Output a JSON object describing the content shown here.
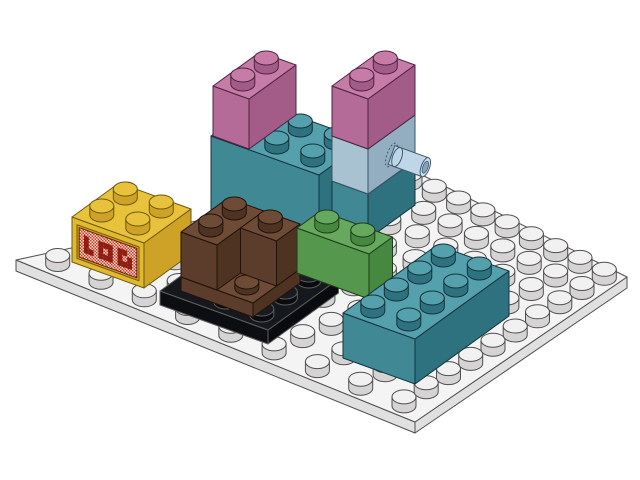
{
  "scene": {
    "description": "Isometric LDraw-style render of a small LEGO assembly on a white studded baseplate",
    "background": "#ffffff",
    "projection": {
      "u": [
        23.5,
        -17
      ],
      "v": [
        36,
        13
      ],
      "brick_height_px": 45,
      "stud": {
        "rx": 12,
        "ry": 7,
        "h": 9
      }
    },
    "baseplate": {
      "part": "white baseplate (approx 10 x 8 studs)",
      "color_name": "white",
      "quad": [
        [
          16,
          260
        ],
        [
          418,
          173
        ],
        [
          627,
          277
        ],
        [
          415,
          422
        ]
      ],
      "cols": 10,
      "rows": 9,
      "thickness": 11,
      "colors": {
        "top": "#f4f4f4",
        "side": "#e1e0e0",
        "stud_top": "#f1f1f1",
        "stud_side": "#d5d3d3",
        "outline": "#4f4f4f"
      }
    },
    "pieces": [
      {
        "id": "wide-teal-brick",
        "part": "Brick 2x3 tall (double height)",
        "color_name": "teal",
        "anchor": [
          211,
          224
        ],
        "w": 2,
        "d": 3,
        "h": 88,
        "studs": "all",
        "colors": {
          "top": "#54a0ac",
          "left": "#3f8894",
          "right": "#2e717f",
          "stud_top": "#54a0ac",
          "stud_side": "#2e717f",
          "outline": "#16333b"
        }
      },
      {
        "id": "pink-brick-1",
        "part": "Brick 1x2x2 tall",
        "color_name": "dark pink",
        "anchor": [
          213,
          136
        ],
        "w": 2,
        "d": 1,
        "h": 50,
        "studs": "all",
        "colors": {
          "top": "#c77ca8",
          "left": "#b56b97",
          "right": "#a35c88",
          "stud_top": "#c77ca8",
          "stud_side": "#a35c88",
          "outline": "#4e2440"
        }
      },
      {
        "id": "tower-teal-brick",
        "part": "Brick 1x2 (tower base)",
        "color_name": "teal",
        "anchor": [
          332,
          226
        ],
        "w": 2,
        "d": 1,
        "h": 45,
        "studs": [],
        "colors": {
          "top": "#54a0ac",
          "left": "#3f8894",
          "right": "#2e717f",
          "stud_top": "#54a0ac",
          "stud_side": "#2e717f",
          "outline": "#16333b"
        }
      },
      {
        "id": "tower-technic-brick",
        "part": "Technic Brick 1x2 with pin",
        "color_name": "light blue",
        "anchor": [
          332,
          181
        ],
        "w": 2,
        "d": 1,
        "h": 45,
        "studs": [],
        "colors": {
          "top": "#c3d6e2",
          "left": "#a9c2d2",
          "right": "#93aec1",
          "stud_top": "#c3d6e2",
          "stud_side": "#93aec1",
          "outline": "#3c5566"
        }
      },
      {
        "id": "pink-brick-2",
        "part": "Brick 1x2x2 tall",
        "color_name": "dark pink",
        "anchor": [
          332,
          136
        ],
        "w": 2,
        "d": 1,
        "h": 50,
        "studs": "all",
        "colors": {
          "top": "#c77ca8",
          "left": "#b56b97",
          "right": "#a35c88",
          "stud_top": "#c77ca8",
          "stud_side": "#a35c88",
          "outline": "#4e2440"
        }
      },
      {
        "id": "yellow-decorated-brick",
        "part": "Brick 2x2 with decorated side panel",
        "color_name": "yellow",
        "anchor": [
          72,
          262
        ],
        "w": 2,
        "d": 2,
        "h": 45,
        "studs": "all",
        "decorated": true,
        "colors": {
          "top": "#e9c23b",
          "left": "#e0b92f",
          "right": "#cda227",
          "stud_top": "#e9c23b",
          "stud_side": "#cda227",
          "outline": "#6d5a11"
        }
      },
      {
        "id": "black-plate",
        "part": "Plate 4x4",
        "color_name": "black",
        "anchor": [
          160,
          305
        ],
        "w": 3,
        "d": 3,
        "h": 14,
        "stud_h": 6,
        "studs": [
          [
            0.5,
            1.5
          ],
          [
            0.5,
            2.5
          ],
          [
            1.5,
            2.5
          ],
          [
            2.5,
            2.5
          ],
          [
            2.5,
            1.5
          ],
          [
            2.5,
            0.5
          ]
        ],
        "colors": {
          "top": "#15181d",
          "left": "#0c0e12",
          "right": "#090b0e",
          "stud_top": "#181b21",
          "stud_side": "#090b0e",
          "outline": "#5d5d5d"
        }
      },
      {
        "id": "brown-plate",
        "part": "Plate 2x2",
        "color_name": "brown",
        "anchor": [
          181,
          291
        ],
        "w": 2,
        "d": 2,
        "h": 14,
        "stud_h": 6,
        "studs": [
          [
            0.5,
            1.5
          ]
        ],
        "colors": {
          "top": "#6e4b37",
          "left": "#5c3d2b",
          "right": "#4e3323",
          "stud_top": "#6e4b37",
          "stud_side": "#4e3323",
          "outline": "#211309"
        }
      },
      {
        "id": "brown-corner-brick",
        "part": "Brick 2x2 corner",
        "color_name": "brown",
        "anchor": [
          181,
          277
        ],
        "multi": true,
        "h": 45,
        "boxes": [
          {
            "da": 0,
            "db": 0,
            "w": 2,
            "d": 1,
            "studs": [
              [
                0.5,
                0.5
              ],
              [
                1.5,
                0.5
              ]
            ]
          },
          {
            "da": 1,
            "db": 1,
            "w": 1,
            "d": 1,
            "studs": [
              [
                0.5,
                0.5
              ]
            ]
          }
        ],
        "colors": {
          "top": "#6e4b37",
          "left": "#5c3d2b",
          "right": "#4e3323",
          "stud_top": "#6e4b37",
          "stud_side": "#4e3323",
          "outline": "#211309"
        }
      },
      {
        "id": "green-brick",
        "part": "Brick 1x2",
        "color_name": "green",
        "anchor": [
          297,
          273
        ],
        "w": 1,
        "d": 2,
        "h": 45,
        "studs": "all",
        "colors": {
          "top": "#66a85e",
          "left": "#55984d",
          "right": "#468840",
          "stud_top": "#66a85e",
          "stud_side": "#468840",
          "outline": "#1e3c1c"
        }
      },
      {
        "id": "teal-brick-2x4",
        "part": "Brick 2x4",
        "color_name": "teal",
        "anchor": [
          343,
          358
        ],
        "w": 4,
        "d": 2,
        "h": 45,
        "studs": "all",
        "colors": {
          "top": "#54a0ac",
          "left": "#3f8894",
          "right": "#2e717f",
          "stud_top": "#54a0ac",
          "stud_side": "#2e717f",
          "outline": "#16333b"
        }
      }
    ],
    "pin": {
      "part": "Technic pin (in technic brick)",
      "color_name": "light blue",
      "start": [
        391.5,
        155
      ],
      "dir": [
        0.94,
        0.339
      ],
      "length": 36,
      "radius": 10,
      "colors": {
        "body": "#bed6e8",
        "cap": "#cfe2f0",
        "hole": "#8aa2b6",
        "outline": "#3f5a6e"
      }
    },
    "decoration": {
      "host": "yellow-decorated-brick",
      "style": "red dithered grille panel with dark red lettering",
      "recess_color": "#c9a41f",
      "dither_red": "#d03426",
      "dither_light": "#f2e3d0",
      "glyph_color": "#8f1d12",
      "border_color": "#7a1510",
      "grid": {
        "cols": 12,
        "rows": 5
      },
      "glyph_cells": [
        [
          1,
          1
        ],
        [
          1,
          2
        ],
        [
          1,
          3
        ],
        [
          2,
          3
        ],
        [
          4,
          1
        ],
        [
          4,
          2
        ],
        [
          4,
          3
        ],
        [
          5,
          1
        ],
        [
          5,
          3
        ],
        [
          6,
          1
        ],
        [
          6,
          2
        ],
        [
          6,
          3
        ],
        [
          8,
          1
        ],
        [
          8,
          2
        ],
        [
          8,
          3
        ],
        [
          9,
          1
        ],
        [
          9,
          3
        ],
        [
          10,
          2
        ],
        [
          10,
          3
        ]
      ]
    }
  }
}
